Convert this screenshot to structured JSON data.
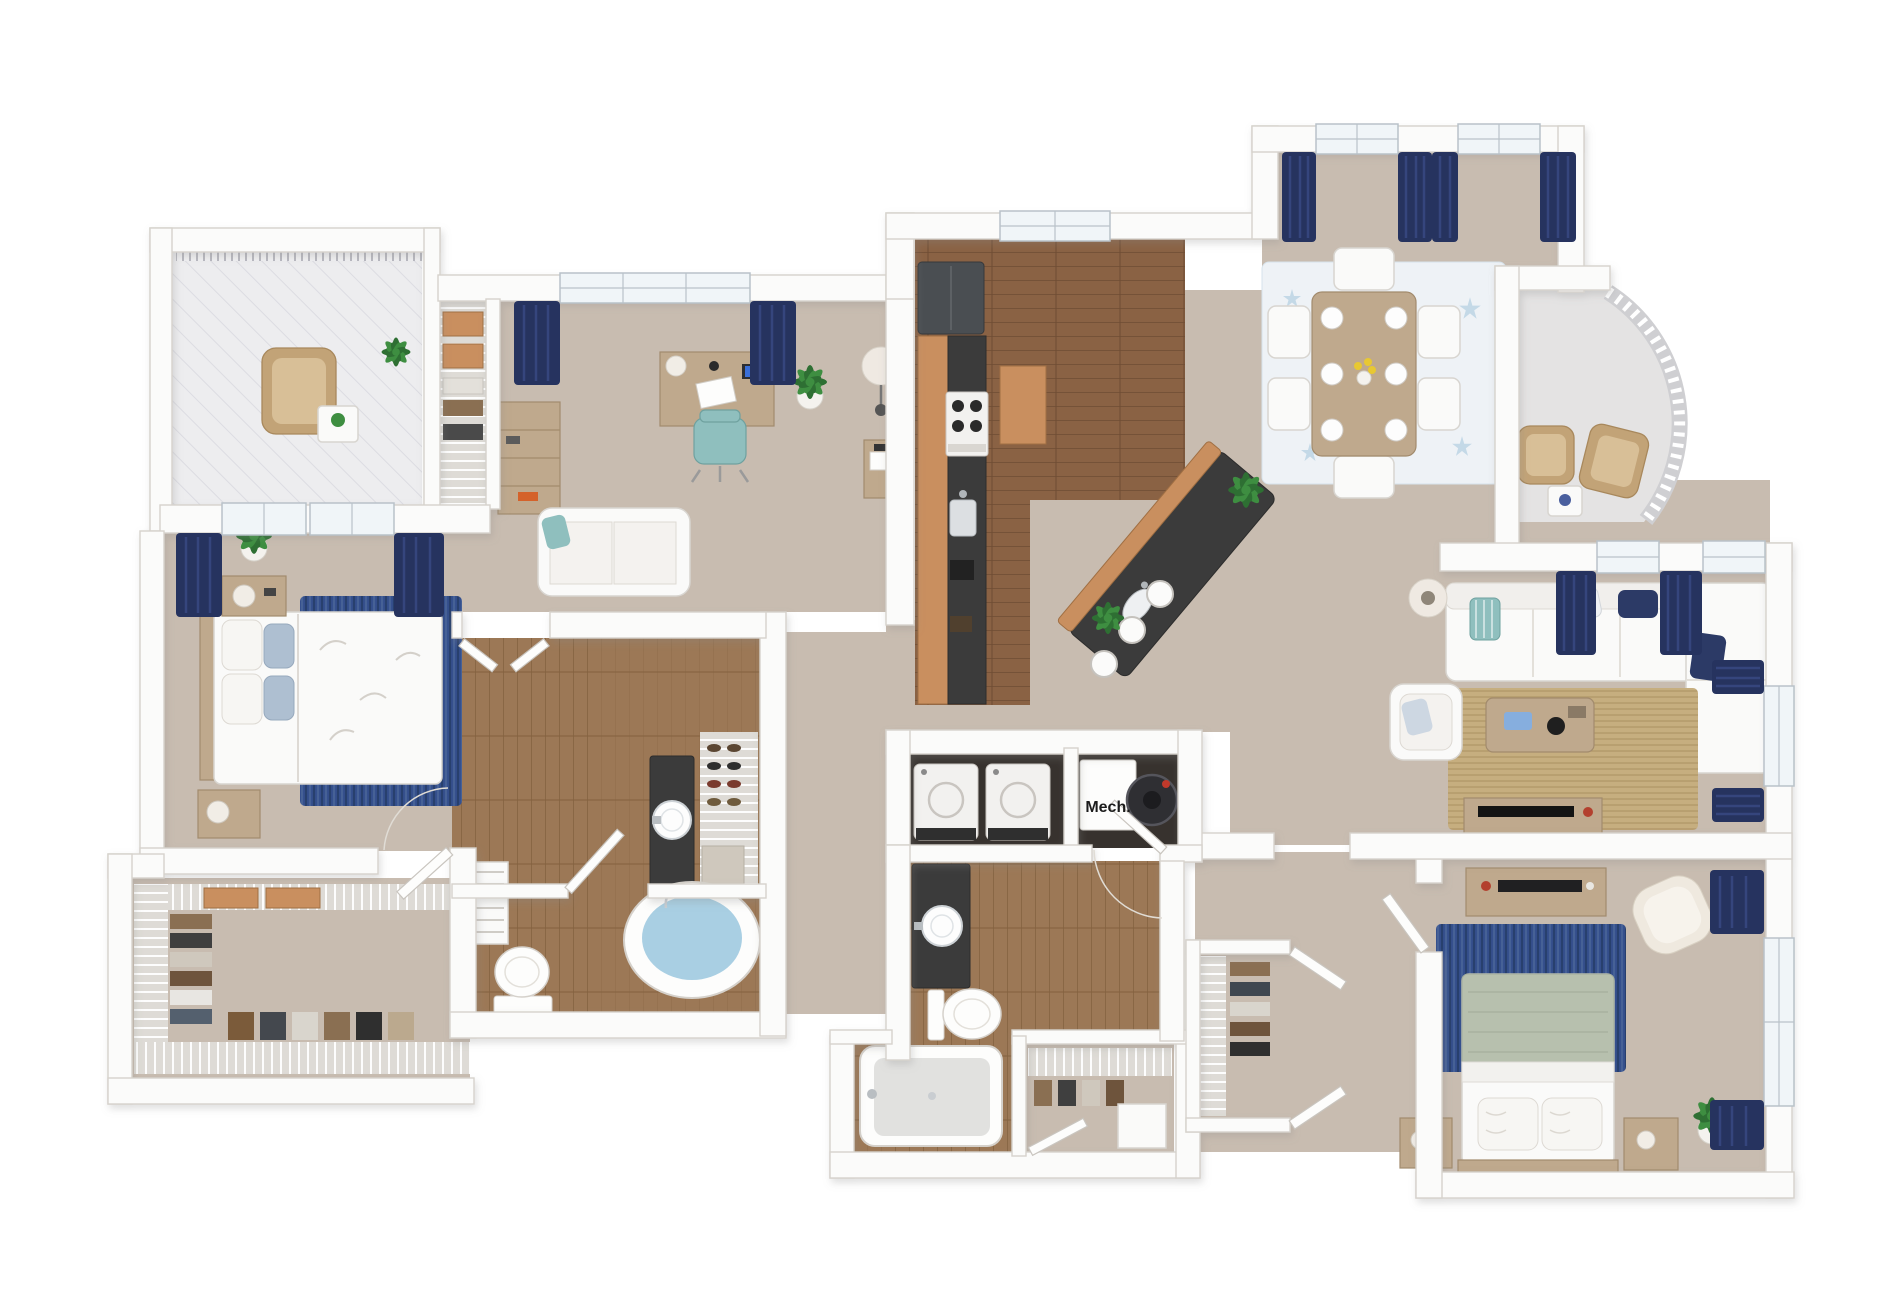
{
  "floorplan": {
    "labels": {
      "mech": "Mech."
    },
    "palette": {
      "wall": "#fbfbfa",
      "wallEdge": "#d6d2cc",
      "carpet": "#c8bcb0",
      "woodKitchen": "#8a6244",
      "woodKitchenLine": "#6e4c33",
      "woodBath": "#9c7856",
      "woodBathLine": "#83613f",
      "balconyFloor": "#ededef",
      "balconyLine": "#dcdce2",
      "concrete": "#e4e3e3",
      "navy": "#26335f",
      "navyLight": "#3a4a85",
      "windowPane": "#f0f5f8",
      "windowFrame": "#b9c2c9",
      "granite": "#3b3b3b",
      "cabinetTan": "#c98f5f",
      "furnWood": "#bfa98d",
      "furnWoodDark": "#a28b6d",
      "white": "#fafaf9",
      "whiteEdge": "#d8d5d0",
      "teal": "#8fbfbe",
      "tealDark": "#6fa19f",
      "blueRug": "#35508d",
      "blueRugDark": "#28406e",
      "blueRugLight": "#5b77a3",
      "sage": "#b7c0ae",
      "jute": "#c6ae7f",
      "juteLine": "#b3996a",
      "green": "#3e8e41",
      "greenDark": "#2e6f33",
      "water": "#a9cfe3",
      "interiorDark": "#37322e",
      "pillowBlue": "#aebfd1",
      "starfish": "#b9d2e3",
      "text": "#1c1c1c"
    },
    "semantics": {
      "rooms": [
        "balcony",
        "linen-closet",
        "den-office",
        "master-bedroom",
        "walk-in-closet",
        "master-bathroom",
        "kitchen",
        "dining-area",
        "curved-balcony",
        "living-room",
        "bedroom-2",
        "bathroom-2",
        "laundry-closet",
        "mechanical-closet",
        "bedroom-2-closet",
        "hallway"
      ],
      "furniture": [
        "wicker-chairs",
        "patio-table",
        "desk",
        "office-chair",
        "bookcase",
        "loveseat",
        "floor-lamps",
        "side-tables",
        "master-bed",
        "nightstands",
        "plants",
        "french-doors",
        "wire-shelving",
        "bench",
        "garden-tub",
        "toilets",
        "vessel-sinks",
        "shoe-shelves",
        "refrigerator",
        "range",
        "kitchen-island",
        "bar-stools",
        "dining-table",
        "dining-chairs",
        "area-rugs",
        "sectional-sofa",
        "armchairs",
        "coffee-table",
        "tv-consoles",
        "queen-bed",
        "accent-chair",
        "washer",
        "dryer",
        "water-heater",
        "bathtub-shower",
        "picture-frames"
      ]
    }
  }
}
